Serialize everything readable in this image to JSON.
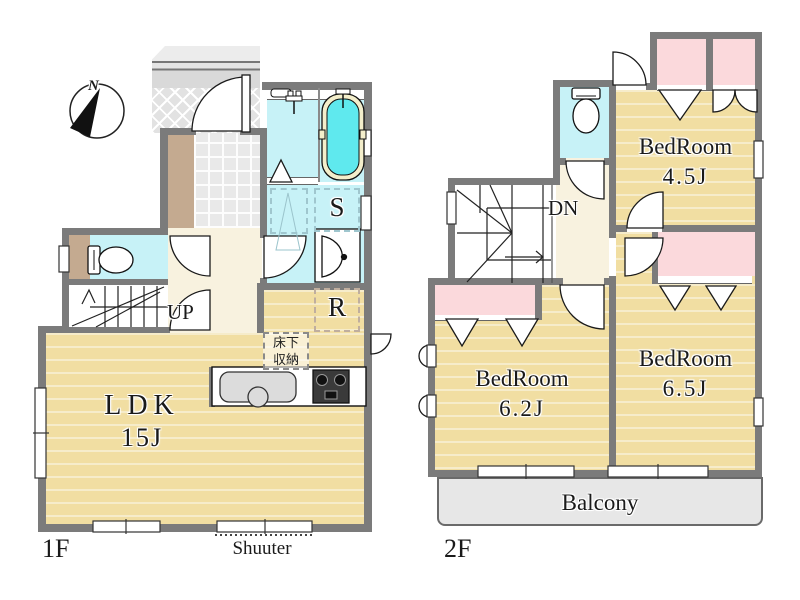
{
  "palette": {
    "wall": "#7b7b7b",
    "tatami_floor": "#f1dea2",
    "wet_area_cyan": "#c7f2f7",
    "bath_water": "#5fe9ee",
    "closet_pink": "#fbd9dc",
    "hall_cream": "#f8f2df",
    "balcony_gray": "#e7e7e7",
    "genkan_brown": "#c4aa90"
  },
  "compass": {
    "north_label": "N"
  },
  "floor1": {
    "floor_label": "1F",
    "ldk_name": "LDK",
    "ldk_size": "15J",
    "stairs_label": "UP",
    "storage_label": "S",
    "refrigerator_label": "R",
    "underfloor_storage_line1": "床下",
    "underfloor_storage_line2": "収納",
    "shutter_label": "Shuuter"
  },
  "floor2": {
    "floor_label": "2F",
    "stairs_label": "DN",
    "bedroom_45_name": "BedRoom",
    "bedroom_45_size": "4.5J",
    "bedroom_62_name": "BedRoom",
    "bedroom_62_size": "6.2J",
    "bedroom_65_name": "BedRoom",
    "bedroom_65_size": "6.5J",
    "balcony_label": "Balcony"
  }
}
